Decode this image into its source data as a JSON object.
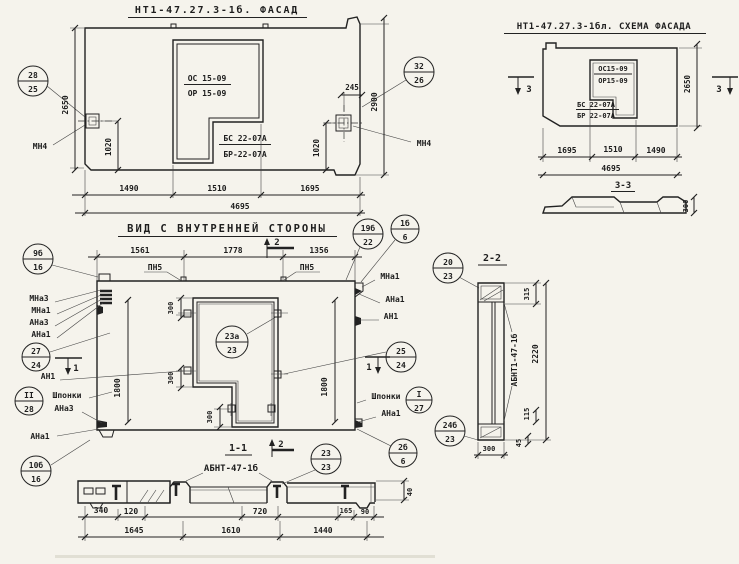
{
  "colors": {
    "paper": "#f5f3ec",
    "ink": "#222222"
  },
  "facade": {
    "title": "НТ1-47.27.3-1б. ФАСАД",
    "window": {
      "l1": "ОС 15-09",
      "l2": "ОР 15-09"
    },
    "door": {
      "l1": "БС 22-07А",
      "l2": "БР-22-07А"
    },
    "anchor_left": "МН4",
    "anchor_right": "МН4",
    "callout_left": {
      "t": "28",
      "b": "25"
    },
    "callout_right": {
      "t": "32",
      "b": "26"
    },
    "dims": {
      "h_left": "2650",
      "h_right": "2900",
      "a_off": "245",
      "v_left": "1020",
      "v_right": "1020",
      "w1": "1490",
      "w2": "1510",
      "w3": "1695",
      "total": "4695"
    }
  },
  "schema": {
    "title": "НТ1-47.27.3-1бл. СХЕМА ФАСАДА",
    "window": {
      "l1": "ОС15-09",
      "l2": "ОР15-09"
    },
    "door": {
      "l1": "БС 22-07А",
      "l2": "БР 22-07А"
    },
    "sec_mark": "3",
    "dims": {
      "h": "2650",
      "w1": "1695",
      "w2": "1510",
      "w3": "1490",
      "total": "4695"
    },
    "section33": {
      "title": "3-3",
      "thk": "300"
    }
  },
  "inner": {
    "title": "ВИД С ВНУТРЕННЕЙ СТОРОНЫ",
    "pn5": "ПН5",
    "sec2": "2",
    "sec1": "1",
    "dims": {
      "t1": "1561",
      "t2": "1778",
      "t3": "1356",
      "w300": "300",
      "h1800": "1800"
    },
    "labels": {
      "mna3": "МНа3",
      "mna1": "МНа1",
      "ana3": "АНа3",
      "ana1": "АНа1",
      "an1": "АН1",
      "shponki": "Шпонки"
    },
    "callouts": {
      "c9b": {
        "t": "9б",
        "b": "16"
      },
      "c27": {
        "t": "27",
        "b": "24"
      },
      "cII": {
        "t": "II",
        "b": "28"
      },
      "c10b": {
        "t": "10б",
        "b": "16"
      },
      "c19b": {
        "t": "19б",
        "b": "22"
      },
      "c1b": {
        "t": "1б",
        "b": "6"
      },
      "c23a": {
        "t": "23а",
        "b": "23"
      },
      "c25": {
        "t": "25",
        "b": "24"
      },
      "cI": {
        "t": "I",
        "b": "27"
      },
      "c2b": {
        "t": "2б",
        "b": "6"
      }
    }
  },
  "sec22": {
    "title": "2-2",
    "label": "АБНТ1-47-1б",
    "dims": {
      "d315": "315",
      "d2220": "2220",
      "d115": "115",
      "d45": "45",
      "d300": "300"
    },
    "callouts": {
      "c20": {
        "t": "20",
        "b": "23"
      },
      "c24b": {
        "t": "24б",
        "b": "23"
      }
    }
  },
  "sec11": {
    "title": "1-1",
    "label": "АБНТ-47-1б",
    "sec2": "2",
    "callout": {
      "t": "23",
      "b": "23"
    },
    "dims": {
      "d340": "340",
      "d120": "120",
      "d720": "720",
      "d165": "165",
      "d90": "90",
      "d40": "40",
      "d1645": "1645",
      "d1610": "1610",
      "d1440": "1440"
    }
  }
}
